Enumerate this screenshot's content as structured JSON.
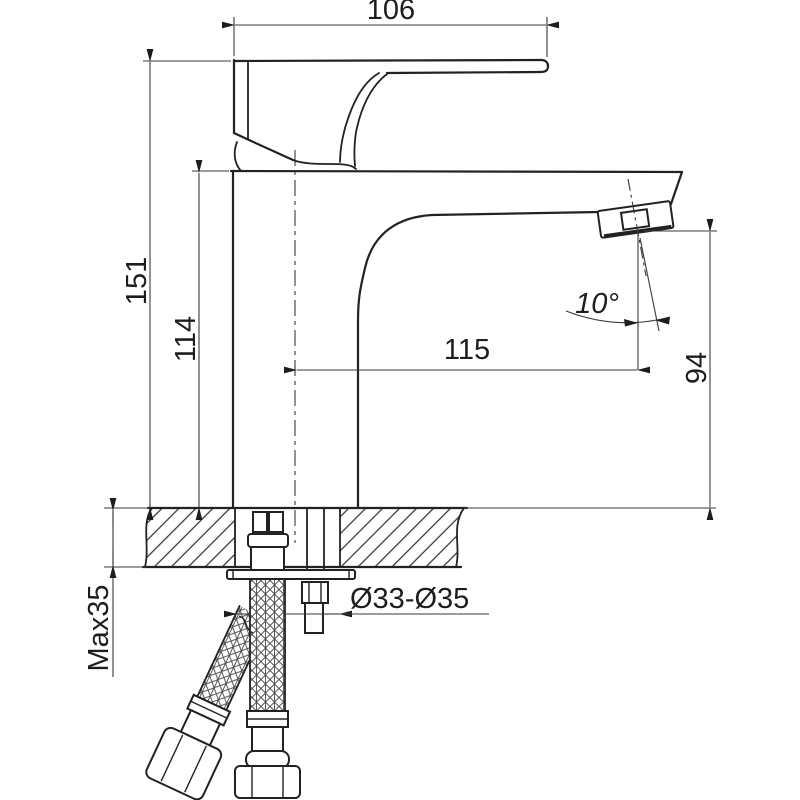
{
  "drawing": {
    "type": "faucet-installation-technical-drawing",
    "background_color": "#ffffff",
    "outline_color": "#222222",
    "dimension_line_color": "#3a3a3a",
    "labels": {
      "handle_length": "106",
      "overall_height": "151",
      "body_height": "114",
      "spout_reach": "115",
      "outlet_height": "94",
      "spout_angle": "10°",
      "mounting_hole_diameter": "Ø33-Ø35",
      "max_counter_thickness": "Max35"
    }
  }
}
